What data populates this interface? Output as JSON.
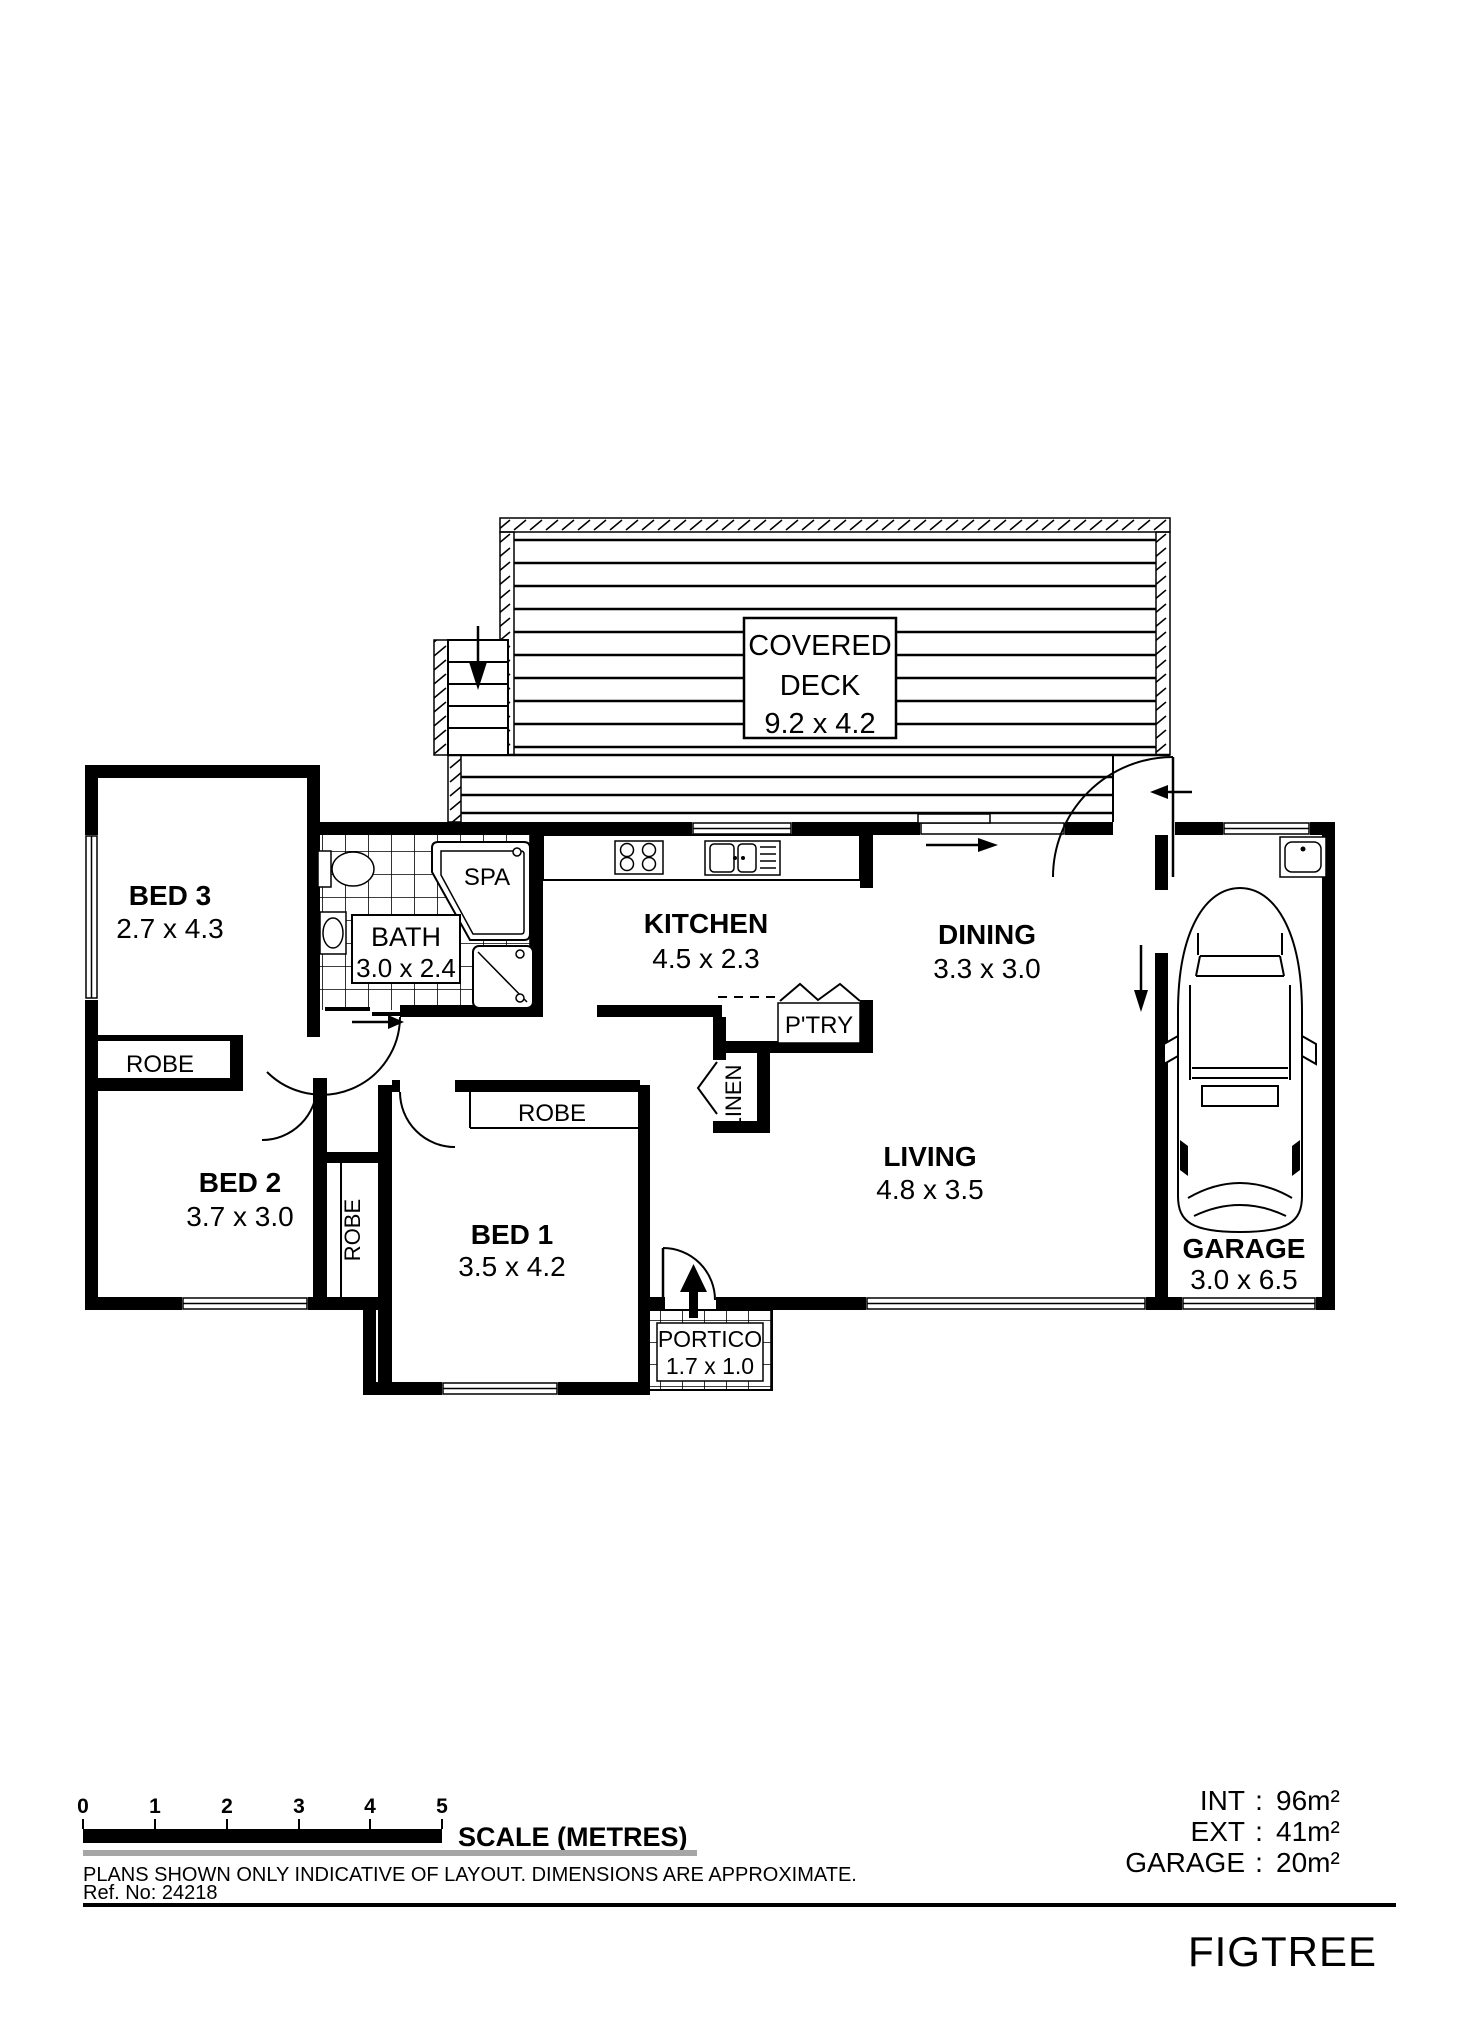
{
  "brand": "FIGTREE",
  "plan": {
    "deck": {
      "line1": "COVERED",
      "line2": "DECK",
      "dims": "9.2 x 4.2"
    },
    "bed3": {
      "name": "BED 3",
      "dims": "2.7 x 4.3"
    },
    "bed2": {
      "name": "BED 2",
      "dims": "3.7 x 3.0"
    },
    "bed1": {
      "name": "BED 1",
      "dims": "3.5 x 4.2"
    },
    "bath": {
      "name": "BATH",
      "dims": "3.0 x 2.4"
    },
    "spa": {
      "name": "SPA"
    },
    "kitchen": {
      "name": "KITCHEN",
      "dims": "4.5 x 2.3"
    },
    "dining": {
      "name": "DINING",
      "dims": "3.3 x 3.0"
    },
    "living": {
      "name": "LIVING",
      "dims": "4.8 x 3.5"
    },
    "garage": {
      "name": "GARAGE",
      "dims": "3.0 x 6.5"
    },
    "portico": {
      "name": "PORTICO",
      "dims": "1.7 x 1.0"
    },
    "pantry": {
      "name": "P'TRY"
    },
    "linen": {
      "name": "LINEN"
    },
    "robe_bed3": {
      "name": "ROBE"
    },
    "robe_hall": {
      "name": "ROBE"
    },
    "robe_bed1": {
      "name": "ROBE"
    }
  },
  "scale": {
    "label": "SCALE (METRES)",
    "ticks": [
      "0",
      "1",
      "2",
      "3",
      "4",
      "5"
    ]
  },
  "areas": [
    {
      "label": "INT",
      "colon": ":",
      "value": "96m²"
    },
    {
      "label": "EXT",
      "colon": ":",
      "value": "41m²"
    },
    {
      "label": "GARAGE",
      "colon": ":",
      "value": "20m²"
    }
  ],
  "footer": {
    "disclaimer": "PLANS SHOWN ONLY INDICATIVE OF LAYOUT.  DIMENSIONS ARE APPROXIMATE.",
    "ref": "Ref. No: 24218"
  }
}
